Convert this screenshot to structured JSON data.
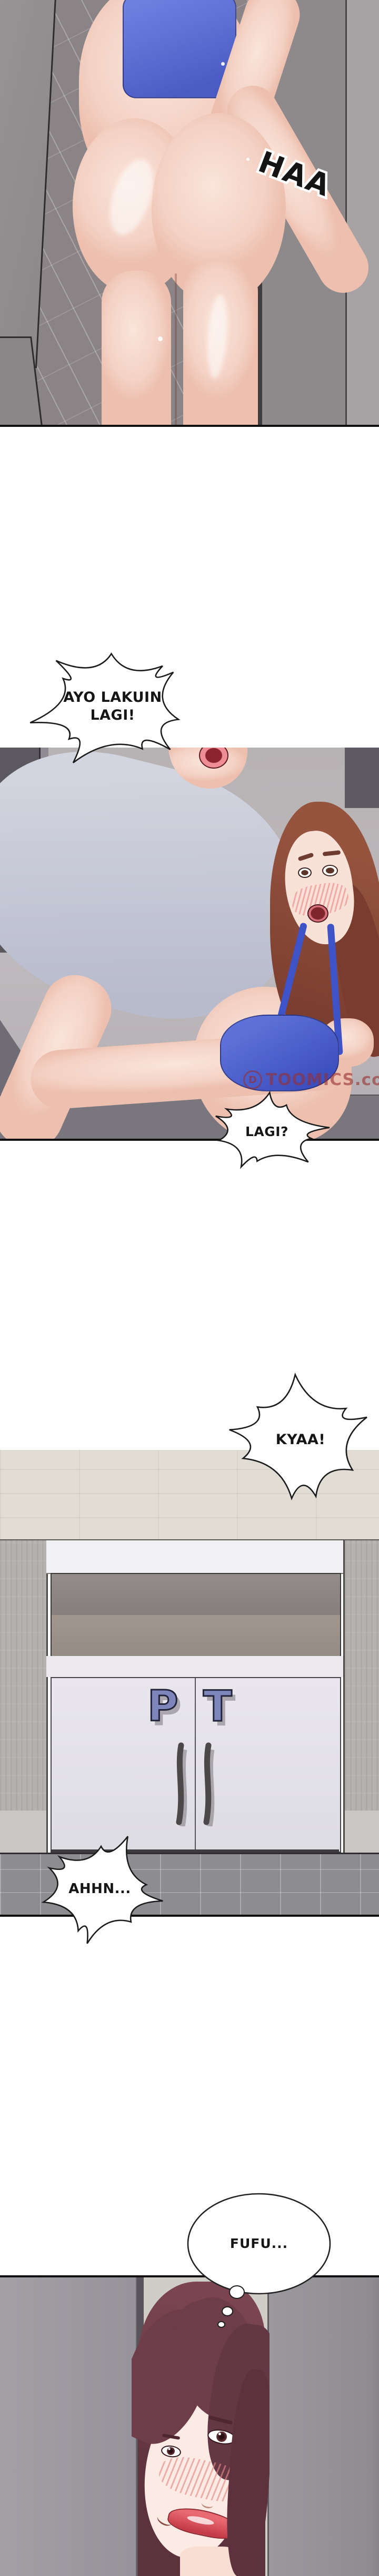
{
  "panels": {
    "p1": {
      "sfx": "HAA"
    },
    "p2": {
      "watermark_logo": "D",
      "watermark": "TOOMICS.com"
    },
    "p3": {
      "door_letter_left": "P",
      "door_letter_right": "T"
    }
  },
  "bubbles": {
    "ayo_lakuin": "AYO LAKUIN LAGI!",
    "lagi": "LAGI?",
    "kyaa": "KYAA!",
    "ahhn": "AHHN...",
    "fufu": "FUFU..."
  },
  "colors": {
    "panel_border": "#101010",
    "sports_bra_blue": "#5166cd",
    "bra_strap_blue": "#3f53c8",
    "man_shirt_gray_blue": "#c5c8d7",
    "woman_hair_auburn": "#8b4a3c",
    "woman_hair_dark_maroon": "#643641",
    "skin_tone": "#f6d8cc",
    "door_sign_purple": "#7d85bb",
    "gym_door_lavender": "#e6e4ea",
    "watermark_red": "#98302f",
    "shower_wall_gray": "#8a8487",
    "gym_floor_gray": "#8d8d91"
  }
}
